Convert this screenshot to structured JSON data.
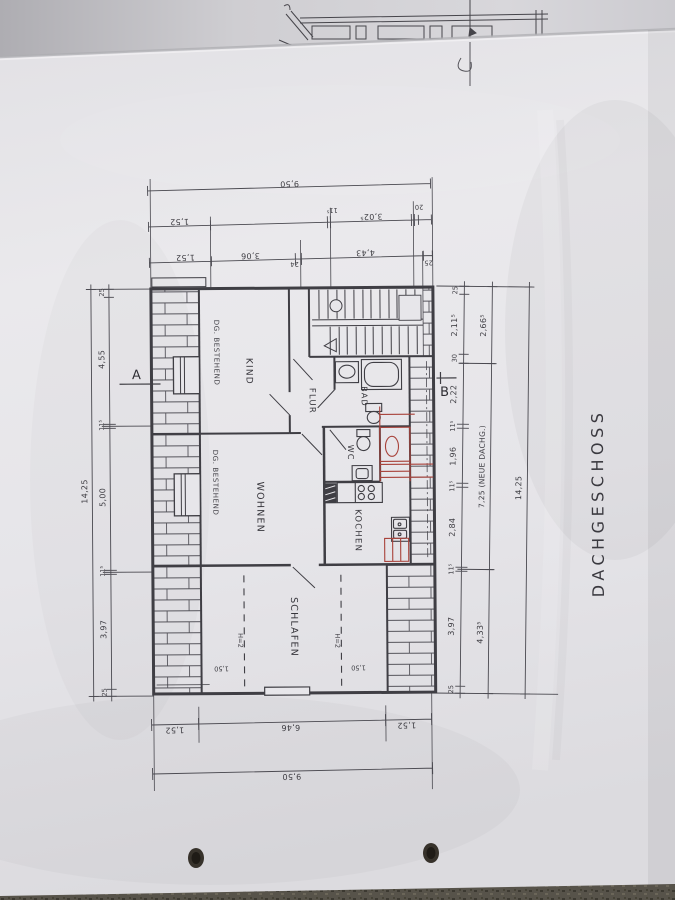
{
  "title": "DACHGESCHOSS",
  "markers": {
    "a": "A",
    "b": "B"
  },
  "rooms": {
    "kind": "KIND",
    "flur": "FLUR",
    "bad": "BAD",
    "wc": "WC",
    "wohnen": "WOHNEN",
    "kochen": "KOCHEN",
    "schlafen": "SCHLAFEN",
    "bestehend_top": "DG. BESTEHEND",
    "bestehend_mid": "DG. BESTEHEND"
  },
  "annotations": {
    "h2_left": "H=2",
    "h2_right": "H=2",
    "h150_left": "1,50",
    "h150_right": "1,50"
  },
  "dimensions": {
    "top_total": "9,50",
    "top2": [
      "1,52",
      "11⁵",
      "3,02⁵",
      "20"
    ],
    "top3": [
      "1,52",
      "3,06",
      "24",
      "4,43",
      "25"
    ],
    "bottom1": [
      "1,52",
      "6,46",
      "1,52"
    ],
    "bottom_total": "9,50",
    "left_chain": [
      "25",
      "4,55",
      "11⁵",
      "5,00",
      "11⁵",
      "3,97",
      "25"
    ],
    "left_total": "14,25",
    "right_chain": [
      "25",
      "2,11⁵",
      "30",
      "2,22",
      "11⁵",
      "1,96",
      "11⁵",
      "2,84",
      "11⁵",
      "3,97",
      "25"
    ],
    "right_outer": [
      "2,66⁵",
      "7,25 (NEUE DACHG.)",
      "4,33⁵"
    ],
    "right_total": "14,25"
  },
  "colors": {
    "ink": "#3f3e44",
    "red_pen": "#a8423a",
    "paper": "#e7e6ea"
  }
}
